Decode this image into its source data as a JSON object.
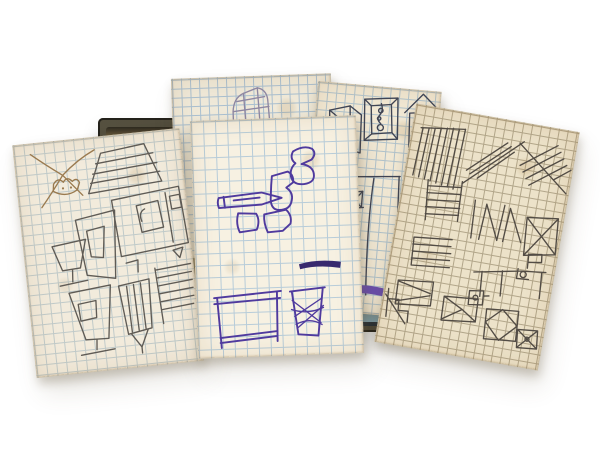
{
  "scene": {
    "type": "photograph",
    "description": "Five vintage graph-paper cards covered in hand-drawn geometric ink doodles, fanned out over an open box on a white background",
    "background_color": "#ffffff"
  },
  "box": {
    "label": "open-storage-box",
    "rim_color": "#4a463a",
    "interior_color": "#a08c60",
    "right_edge_color": "#2e3d38",
    "lip_color": "#8fb9c9",
    "base_line_color": "#202c3a"
  },
  "cards": [
    {
      "label": "card-far-left",
      "paper_color": "#f2ebdc",
      "grid_color": "#c0cac9",
      "ink_color": "#5f5b55",
      "accent_ink_color": "#9a7a4f",
      "motifs": [
        "star-doodle",
        "lampshade",
        "window-grid",
        "nested-quads",
        "small-goblet",
        "large-goblet",
        "striped-beaker",
        "ladder-stripes"
      ]
    },
    {
      "label": "card-back-center",
      "paper_color": "#efe9d9",
      "grid_color": "#a9bfd0",
      "ink_color": "#8e87a2",
      "accent_ink_color": "#8e87a2",
      "motifs": [
        "faceted-tower"
      ]
    },
    {
      "label": "card-front-center",
      "paper_color": "#f7f1e2",
      "grid_color": "#b7ccd9",
      "ink_color": "#4f3a9e",
      "accent_ink_color": "#38296e",
      "motifs": [
        "abstract-blobs",
        "pencil-shape",
        "taper-stroke",
        "table-frame",
        "crosshatch-basket"
      ]
    },
    {
      "label": "card-back-right",
      "paper_color": "#f1e8d4",
      "grid_color": "#b0c2cb",
      "ink_color": "#3f4454",
      "accent_ink_color": "#6b4fae",
      "motifs": [
        "wireframe-box",
        "picture-frame-with-chain",
        "birdhouse-on-post",
        "truss-x",
        "long-lines",
        "purple-squiggle"
      ]
    },
    {
      "label": "card-front-right",
      "paper_color": "#ece2c9",
      "grid_color": "#b2a68a",
      "ink_color": "#524c45",
      "accent_ink_color": "#524c45",
      "motifs": [
        "stripe-block",
        "diagonal-hatches",
        "rail-ladder",
        "line-stack",
        "zigzag-n",
        "x-square",
        "flag-marker",
        "t-lines",
        "stair-zigzag",
        "envelope-row"
      ]
    }
  ]
}
